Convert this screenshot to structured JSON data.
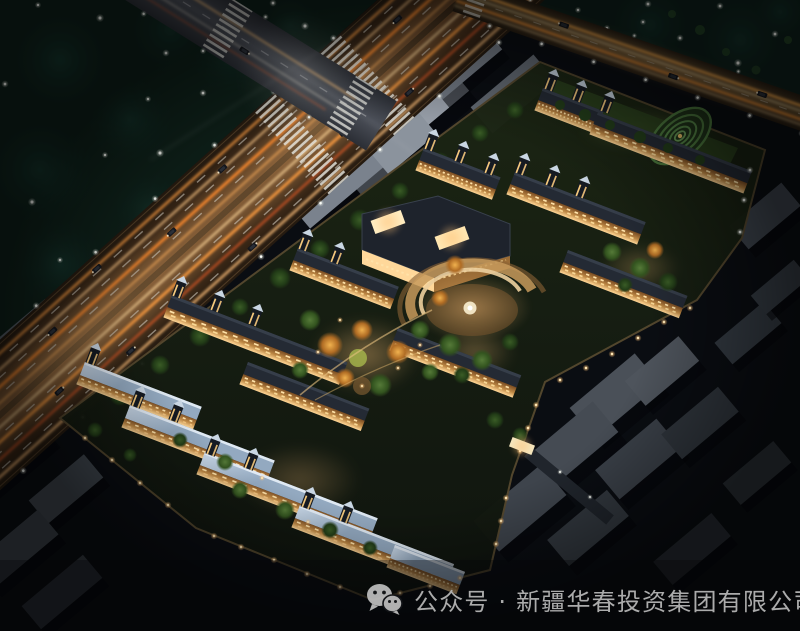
{
  "image": {
    "subject": "aerial night rendering of a residential community beside a lit highway intersection"
  },
  "watermark": {
    "icon": "wechat-icon",
    "text": "公众号 · 新疆华春投资集团有限公司"
  },
  "palette": {
    "night_base": "#0a0d12",
    "vegetation_dark": "#10271f",
    "road_glow": "#e89a45",
    "light_trail": "#ffb56b",
    "tail_light": "#e85c2a",
    "window_warm": "#ffe2a8",
    "facade_lit": "#c08a46",
    "roof_dark": "#242a34",
    "roof_moonlit": "#a9bed2",
    "context_building_gray": "#8b939d",
    "tree_green": "#3c5a26",
    "autumn_tree": "#cc8433",
    "lamp_white": "#f4f6f0",
    "watermark_text": "#b4b4b4"
  }
}
